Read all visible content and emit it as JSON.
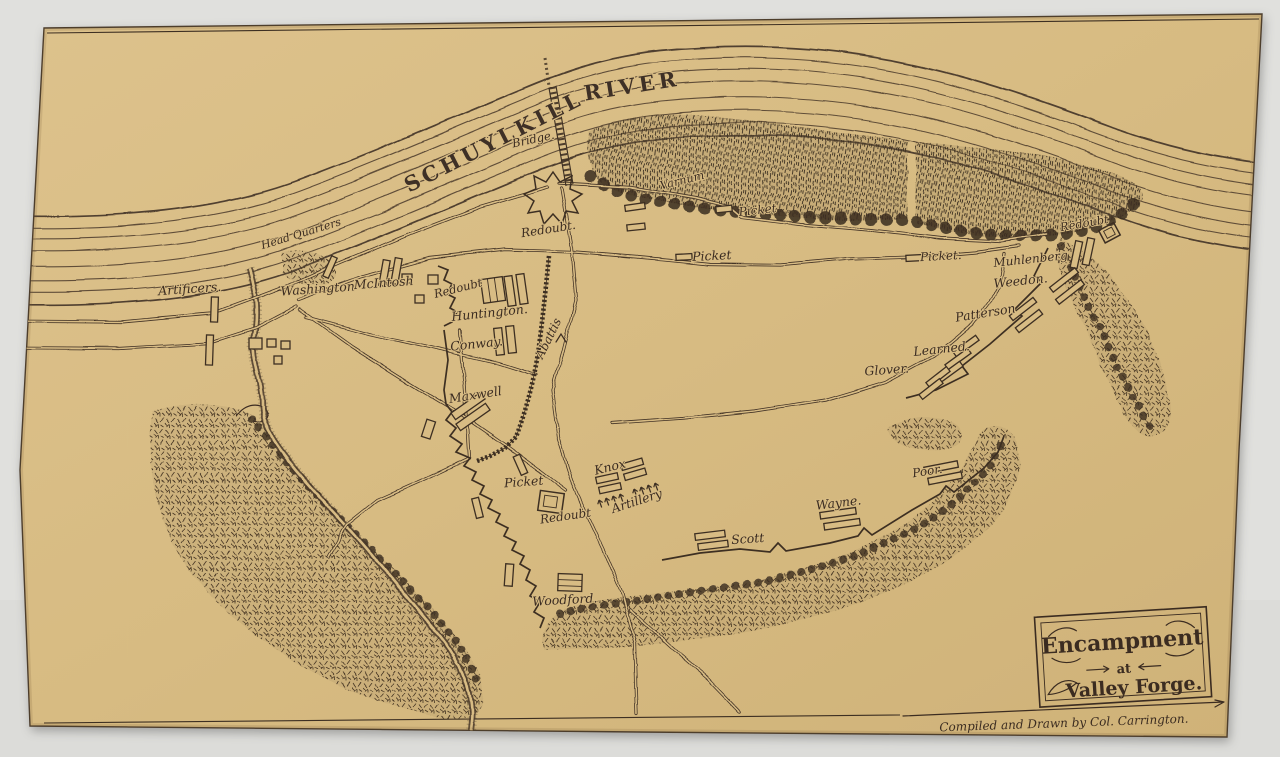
{
  "scan": {
    "mat_color": "#e1e1de",
    "paper_color": "#d8bc84",
    "ink_color": "#3d2f24"
  },
  "map": {
    "river": {
      "name_part1": "SCHUYLKILL",
      "name_part2": "RIVER",
      "bridge": "Bridge."
    },
    "labels": {
      "head_quarters": "Head Quarters",
      "artificers": "Artificers.",
      "washington": "Washington",
      "mcintosh": "McIntosh",
      "redoubt_north": "Redoubt.",
      "redoubt_inner": "Redoubt",
      "huntington": "Huntington.",
      "conway": "Conway.",
      "abattis": "Abattis",
      "varnum": "Varnum",
      "picket_north_a": "Picket",
      "picket_north_b": "Picket",
      "picket_east": "Picket.",
      "redoubt_east": "Redoubt",
      "muhlenberg": "Muhlenberg",
      "weedon": "Weedon.",
      "patterson": "Patterson",
      "learned": "Learned.",
      "glover": "Glover.",
      "maxwell": "Maxwell",
      "picket_center": "Picket",
      "redoubt_center": "Redoubt",
      "knox": "Knox",
      "artillery": "Artillery",
      "scott": "Scott",
      "wayne": "Wayne.",
      "poor": "Poor.",
      "woodford": "Woodford."
    },
    "title_box": {
      "line1": "Encampment",
      "line2": "at",
      "line3": "Valley Forge."
    },
    "credit": "Compiled and Drawn by Col. Carrington."
  }
}
